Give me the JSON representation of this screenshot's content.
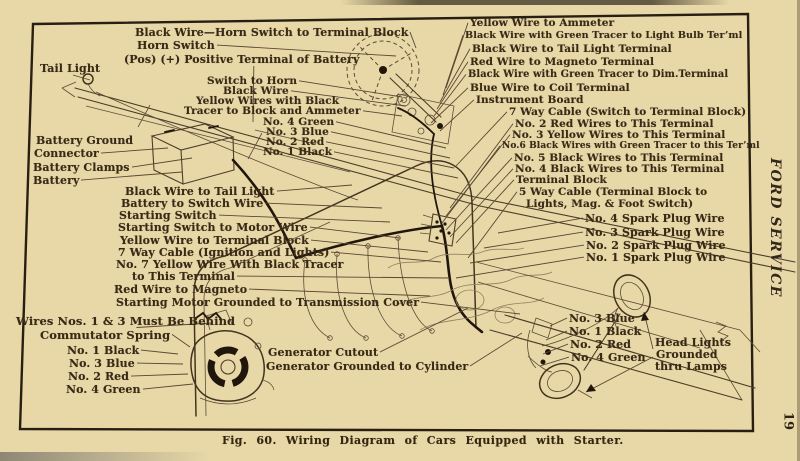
{
  "page": {
    "caption": "Fig. 60.  Wiring Diagram of Cars Equipped with Starter.",
    "margin": {
      "title": "FORD SERVICE",
      "page_number": "19"
    }
  },
  "colors": {
    "paper": "#e8d8a8",
    "ink": "#392a16",
    "frame_line": "#281f13",
    "leader": "#5a4732",
    "wire_dark": "#20160c"
  },
  "labels": [
    {
      "text": "Black Wire—Horn Switch to Terminal Block",
      "x": 135,
      "y": 26,
      "size": 11,
      "to": [
        416,
        48
      ]
    },
    {
      "text": "Horn Switch",
      "x": 137,
      "y": 39,
      "size": 11,
      "to": [
        396,
        56
      ]
    },
    {
      "text": "(Pos) (+) Positive Terminal of Battery",
      "x": 124,
      "y": 53,
      "size": 11,
      "to": [
        253,
        122
      ]
    },
    {
      "text": "Tail Light",
      "x": 40,
      "y": 62,
      "size": 11,
      "to": [
        90,
        80
      ]
    },
    {
      "text": "Switch to Horn",
      "x": 207,
      "y": 75,
      "to": [
        402,
        97
      ]
    },
    {
      "text": "Black Wire",
      "x": 223,
      "y": 85,
      "to": [
        406,
        106
      ]
    },
    {
      "text": "Yellow Wires with Black",
      "x": 196,
      "y": 95
    },
    {
      "text": "Tracer to Block and Ammeter",
      "x": 184,
      "y": 105,
      "to": [
        402,
        116
      ]
    },
    {
      "text": "No. 4 Green",
      "x": 263,
      "y": 116,
      "to": [
        446,
        148
      ]
    },
    {
      "text": "No. 3 Blue",
      "x": 266,
      "y": 126,
      "to": [
        450,
        158
      ]
    },
    {
      "text": "No. 2 Red",
      "x": 266,
      "y": 136,
      "to": [
        454,
        168
      ]
    },
    {
      "text": "No. 1 Black",
      "x": 263,
      "y": 146,
      "to": [
        458,
        178
      ]
    },
    {
      "text": "Battery Ground",
      "x": 36,
      "y": 134,
      "size": 11
    },
    {
      "text": "Connector",
      "x": 34,
      "y": 147,
      "size": 11,
      "to": [
        168,
        148
      ]
    },
    {
      "text": "Battery Clamps",
      "x": 33,
      "y": 161,
      "size": 11,
      "to": [
        192,
        158
      ]
    },
    {
      "text": "Battery",
      "x": 33,
      "y": 174,
      "size": 11,
      "to": [
        182,
        172
      ]
    },
    {
      "text": "Black Wire to Tail Light",
      "x": 125,
      "y": 185,
      "size": 11,
      "to": [
        352,
        185
      ]
    },
    {
      "text": "Battery to Switch Wire",
      "x": 121,
      "y": 197,
      "size": 11,
      "to": [
        382,
        208
      ]
    },
    {
      "text": "Starting Switch",
      "x": 119,
      "y": 209,
      "size": 11,
      "to": [
        390,
        222
      ]
    },
    {
      "text": "Starting Switch to Motor Wire",
      "x": 118,
      "y": 221,
      "size": 11,
      "to": [
        400,
        238
      ]
    },
    {
      "text": "Yellow Wire to Terminal Block",
      "x": 120,
      "y": 234,
      "size": 11,
      "to": [
        428,
        252
      ]
    },
    {
      "text": "7 Way Cable (Ignition and Lights)",
      "x": 118,
      "y": 246,
      "size": 11,
      "to": [
        441,
        262
      ]
    },
    {
      "text": "No. 7 Yellow Wire With Black Tracer",
      "x": 116,
      "y": 258,
      "size": 11
    },
    {
      "text": "to This Terminal",
      "x": 132,
      "y": 270,
      "size": 11,
      "to": [
        448,
        278
      ]
    },
    {
      "text": "Red Wire to Magneto",
      "x": 114,
      "y": 283,
      "size": 11,
      "to": [
        430,
        296
      ]
    },
    {
      "text": "Starting Motor Grounded to Transmission Cover",
      "x": 116,
      "y": 296,
      "size": 11,
      "to": [
        520,
        314
      ]
    },
    {
      "text": "Yellow Wire to Ammeter",
      "x": 470,
      "y": 17,
      "to": [
        446,
        88
      ]
    },
    {
      "text": "Black Wire with Green Tracer to Light Bulb Ter’ml",
      "x": 465,
      "y": 30,
      "size": 9.6,
      "to": [
        443,
        95
      ]
    },
    {
      "text": "Black Wire to Tail Light Terminal",
      "x": 472,
      "y": 43,
      "to": [
        440,
        102
      ]
    },
    {
      "text": "Red Wire to Magneto Terminal",
      "x": 470,
      "y": 56,
      "to": [
        437,
        109
      ]
    },
    {
      "text": "Black Wire with Green Tracer to Dim.Terminal",
      "x": 468,
      "y": 69,
      "size": 9.8,
      "to": [
        434,
        116
      ]
    },
    {
      "text": "Blue Wire to Coil Terminal",
      "x": 470,
      "y": 82,
      "to": [
        431,
        123
      ]
    },
    {
      "text": "Instrument Board",
      "x": 476,
      "y": 94,
      "to": [
        440,
        131
      ]
    },
    {
      "text": "7 Way Cable (Switch to Terminal Block)",
      "x": 509,
      "y": 106,
      "to": [
        456,
        166
      ]
    },
    {
      "text": "No. 2 Red Wires to This Terminal",
      "x": 515,
      "y": 118,
      "to": [
        450,
        208
      ]
    },
    {
      "text": "No. 3 Yellow Wires to This Terminal",
      "x": 512,
      "y": 129,
      "to": [
        446,
        216
      ]
    },
    {
      "text": "No.6 Black Wires with Green Tracer to this Ter’ml",
      "x": 502,
      "y": 141,
      "size": 9,
      "to": [
        442,
        223
      ]
    },
    {
      "text": "No. 5 Black Wires to This Terminal",
      "x": 514,
      "y": 152,
      "to": [
        446,
        230
      ]
    },
    {
      "text": "No. 4 Black Wires to This Terminal",
      "x": 515,
      "y": 163,
      "to": [
        450,
        237
      ]
    },
    {
      "text": "Terminal Block",
      "x": 516,
      "y": 174,
      "to": [
        456,
        243
      ]
    },
    {
      "text": "5 Way Cable (Terminal Block to",
      "x": 519,
      "y": 186,
      "to": [
        468,
        258
      ]
    },
    {
      "text": "Lights, Mag. & Foot Switch)",
      "x": 526,
      "y": 198
    },
    {
      "text": "No. 4 Spark Plug Wire",
      "x": 585,
      "y": 212,
      "size": 11,
      "to": [
        498,
        233
      ]
    },
    {
      "text": "No. 3 Spark Plug Wire",
      "x": 585,
      "y": 226,
      "size": 11,
      "to": [
        484,
        248
      ]
    },
    {
      "text": "No. 2 Spark Plug Wire",
      "x": 586,
      "y": 239,
      "size": 11,
      "to": [
        470,
        263
      ]
    },
    {
      "text": "No. 1 Spark Plug Wire",
      "x": 586,
      "y": 251,
      "size": 11,
      "to": [
        456,
        278
      ]
    },
    {
      "text": "Wires Nos. 1 & 3 Must Be Behind",
      "x": 16,
      "y": 314,
      "size": 11.5,
      "to": [
        212,
        323
      ]
    },
    {
      "text": "Commutator Spring",
      "x": 40,
      "y": 328,
      "size": 11.5,
      "to": [
        190,
        347
      ]
    },
    {
      "text": "No. 1 Black",
      "x": 67,
      "y": 344,
      "size": 11,
      "to": [
        178,
        354
      ]
    },
    {
      "text": "No. 3 Blue",
      "x": 69,
      "y": 357,
      "size": 11,
      "to": [
        183,
        364
      ]
    },
    {
      "text": "No. 2 Red",
      "x": 68,
      "y": 370,
      "size": 11,
      "to": [
        188,
        374
      ]
    },
    {
      "text": "No. 4 Green",
      "x": 66,
      "y": 383,
      "size": 11,
      "to": [
        193,
        384
      ]
    },
    {
      "text": "Generator Cutout",
      "x": 268,
      "y": 346,
      "size": 11,
      "to": [
        468,
        308
      ]
    },
    {
      "text": "Generator Grounded to Cylinder",
      "x": 266,
      "y": 360,
      "size": 11,
      "to": [
        522,
        333
      ]
    },
    {
      "text": "No. 3 Blue",
      "x": 569,
      "y": 312,
      "size": 11,
      "to": [
        550,
        326
      ]
    },
    {
      "text": "No. 1 Black",
      "x": 569,
      "y": 325,
      "size": 11,
      "to": [
        546,
        340
      ]
    },
    {
      "text": "No. 2 Red",
      "x": 570,
      "y": 338,
      "size": 11,
      "to": [
        543,
        354
      ]
    },
    {
      "text": "No. 4 Green",
      "x": 571,
      "y": 351,
      "size": 11,
      "to": [
        540,
        366
      ]
    },
    {
      "text": "Head Lights",
      "x": 655,
      "y": 336,
      "size": 11
    },
    {
      "text": "Grounded",
      "x": 656,
      "y": 348,
      "size": 11
    },
    {
      "text": "thru Lamps",
      "x": 655,
      "y": 360,
      "size": 11
    }
  ]
}
